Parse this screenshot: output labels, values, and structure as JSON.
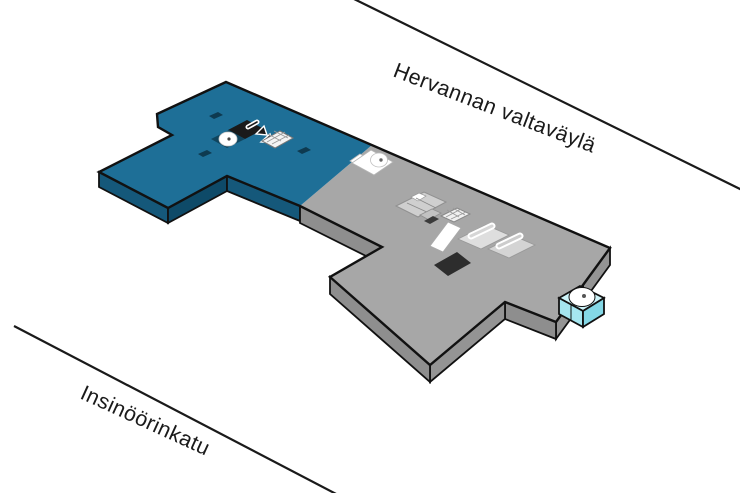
{
  "streets": {
    "top": {
      "label": "Hervannan valtaväylä"
    },
    "bottom": {
      "label": "Insinöörinkatu"
    }
  },
  "building": {
    "name": "isometric-campus-floor-map",
    "sections": [
      {
        "id": "blue-section",
        "color": "#1E6F97"
      },
      {
        "id": "gray-section",
        "color": "#A7A7A7"
      }
    ],
    "features": [
      {
        "icon": "stairs-dark-icon",
        "section": "blue-section"
      },
      {
        "icon": "elevator-round-icon",
        "section": "blue-section"
      },
      {
        "icon": "escalator-arrows-icon",
        "section": "blue-section"
      },
      {
        "icon": "stairs-hatched-icon",
        "section": "blue-section"
      },
      {
        "icon": "landing-round-icon",
        "section": "boundary"
      },
      {
        "icon": "room-cluster",
        "section": "gray-section"
      },
      {
        "icon": "stairs-hatched-icon",
        "section": "gray-section"
      },
      {
        "icon": "white-corridor",
        "section": "gray-section"
      },
      {
        "icon": "stairs-ring-icon",
        "section": "gray-section"
      },
      {
        "icon": "dark-opening",
        "section": "gray-section"
      },
      {
        "icon": "elevator-tower-icon",
        "section": "gray-section"
      }
    ]
  },
  "palette": {
    "background": "#ffffff",
    "line": "#1a1a1a",
    "text": "#1a1a1a",
    "outline": "#111111",
    "blue_top": "#1e6f97",
    "blue_side_sw": "#15587a",
    "blue_side_se": "#0e4a68",
    "gray_top": "#a7a7a7",
    "gray_side_sw": "#8e8e8e",
    "gray_side_se": "#949494",
    "cyan_top": "#cdf4f9",
    "cyan_side_left": "#a5e6f0",
    "cyan_side_right": "#84d8e6",
    "icon_dark": "#1a1a1a"
  }
}
